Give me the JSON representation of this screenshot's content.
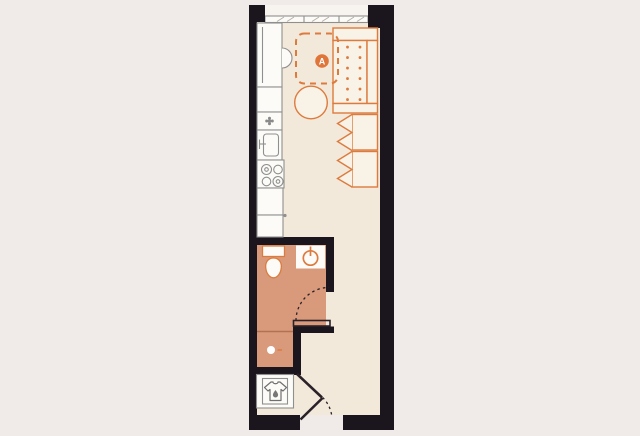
{
  "plan": {
    "zone_label": "A"
  },
  "colors": {
    "background": "#f0ebe9",
    "wall": "#1b151d",
    "floor": "#f3e9da",
    "bathroom_floor": "#d99a7c",
    "accent": "#dd7b3e",
    "badge": "#e0753a",
    "fixture_stroke": "#8f8f8f",
    "fixture_fill": "#fcfbf8",
    "furniture_fill": "#f9f2e6",
    "door_line": "#2a2228",
    "window_hatch": "#b5b0aa",
    "icon_gray": "#777777",
    "shower_line": "#b07250",
    "exterior_strip": "#f7f4f0"
  },
  "icons": {
    "laundry": "tshirt-droplet-icon",
    "kitchen_vent": "flower-vent-icon",
    "bathroom_basin": "circle-drain-icon",
    "zone_marker": "circle-badge-icon"
  }
}
